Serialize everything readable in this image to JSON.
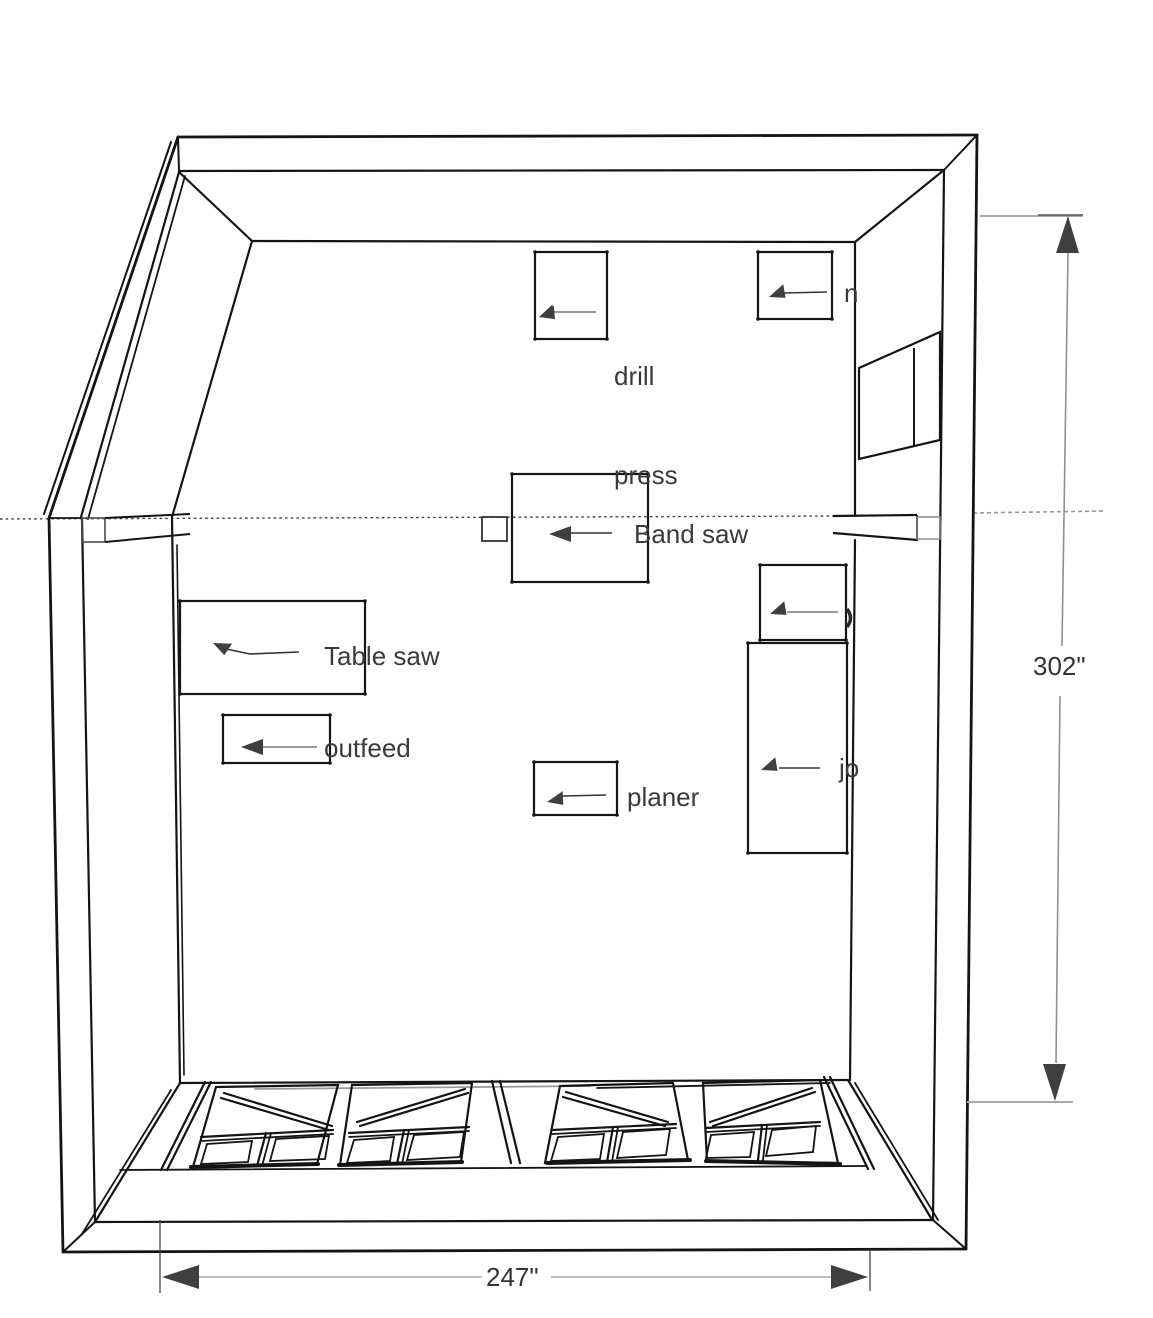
{
  "title": "workshop floor plan sketch",
  "labels": {
    "drill_press": {
      "line1": "drill",
      "line2": "press"
    },
    "band_saw": "Band saw",
    "table_saw": "Table saw",
    "outfeed": "outfeed",
    "planer": "planer",
    "jointer_fragment": "jo",
    "unknown_top_right_fragment": "n"
  },
  "dimensions": {
    "vertical_right": "302\"",
    "horizontal_bottom": "247\""
  },
  "colors": {
    "ink": "#141414",
    "leader_gray": "#9a9a9a",
    "leader_dark": "#333333",
    "arrow_fill": "#3f3f3f",
    "text": "#3a3a3a",
    "dim_line": "#a9a9a9"
  }
}
